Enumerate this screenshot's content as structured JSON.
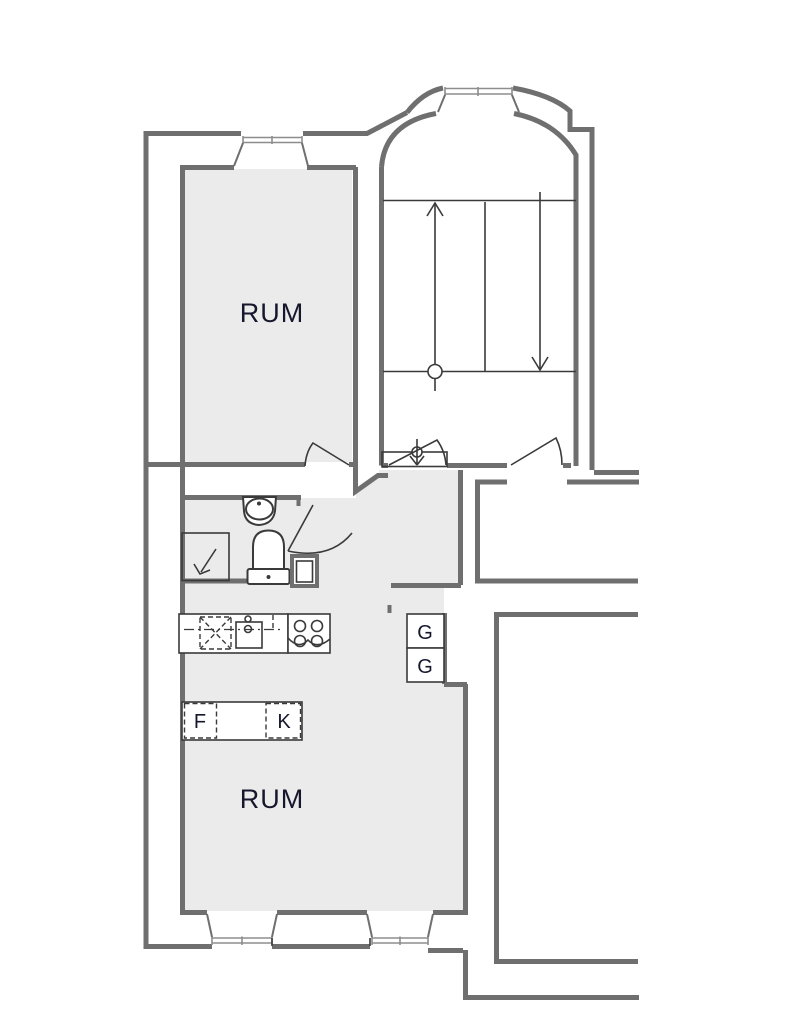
{
  "document": {
    "type": "apartment-floor-plan"
  },
  "colors": {
    "background": "#ffffff",
    "floor_fill": "#ebebeb",
    "wall": "#6f6f6f",
    "fixture_line": "#3a3a3a",
    "window_line": "#8d8d8d",
    "label_text": "#16162d"
  },
  "labels": {
    "room_upper": "RUM",
    "room_lower": "RUM",
    "wardrobe_1": "G",
    "wardrobe_2": "G",
    "freezer": "F",
    "fridge": "K"
  }
}
